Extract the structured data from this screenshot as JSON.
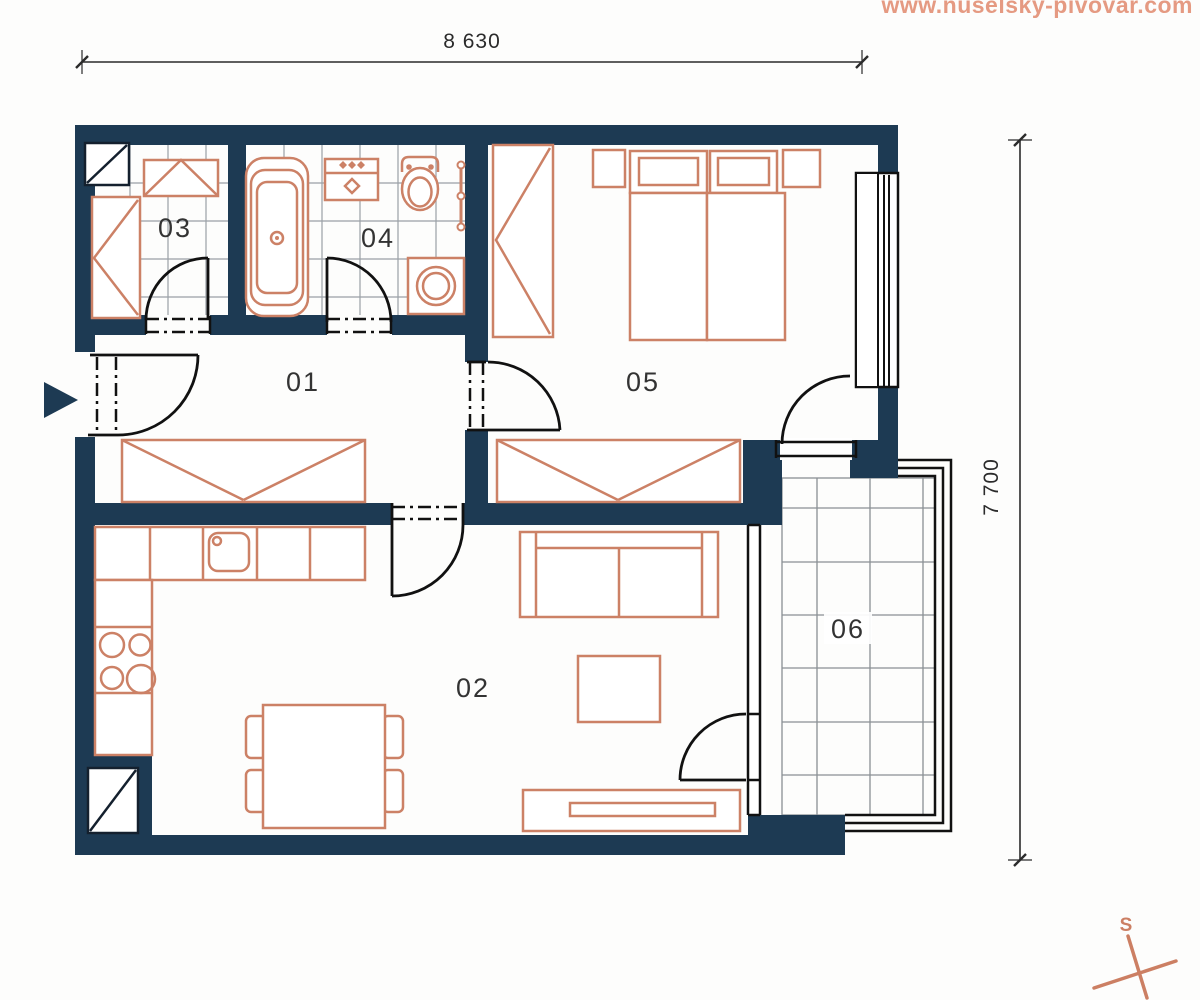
{
  "watermark": "www.nuselsky-pivovar.com",
  "dimensions": {
    "width_label": "8 630",
    "height_label": "7 700"
  },
  "room_labels": {
    "hall": "01",
    "living": "02",
    "closet": "03",
    "bathroom": "04",
    "bedroom": "05",
    "balcony": "06"
  },
  "compass": {
    "north_label": "S"
  },
  "colors": {
    "wall": "#1d3a53",
    "furniture_outline": "#cc8166",
    "linework": "#111111",
    "tile_grid": "#9aa0a6",
    "watermark": "#e59a82",
    "compass": "#cc7f63"
  }
}
